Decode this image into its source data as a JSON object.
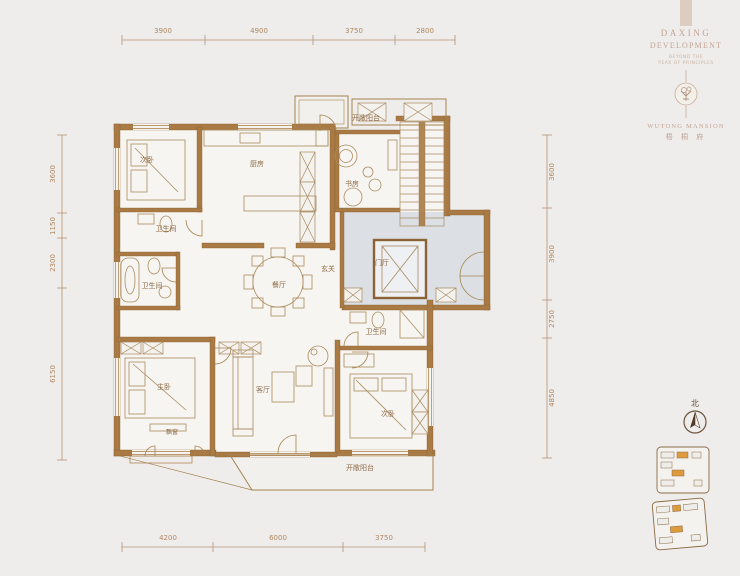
{
  "branding": {
    "developer_line1": "DAXING",
    "developer_line2": "DEVELOPMENT",
    "tagline_line1": "BEYOND THE",
    "tagline_line2": "PEAK OF PRINCIPLES",
    "project_name_en": "WUTONG MANSION",
    "project_name_cn": "梧 桐 府"
  },
  "compass": {
    "north_label": "北"
  },
  "floor_plan": {
    "rooms": [
      {
        "id": "bedroom2",
        "label": "次卧"
      },
      {
        "id": "kitchen",
        "label": "厨房"
      },
      {
        "id": "study",
        "label": "书房"
      },
      {
        "id": "bath-top",
        "label": "卫生间"
      },
      {
        "id": "bath-left",
        "label": "卫生间"
      },
      {
        "id": "dining",
        "label": "餐厅"
      },
      {
        "id": "hallway",
        "label": "玄关"
      },
      {
        "id": "foyer",
        "label": "门厅"
      },
      {
        "id": "balcony-top",
        "label": "开敞阳台"
      },
      {
        "id": "bath-bottom",
        "label": "卫生间"
      },
      {
        "id": "master-bedroom",
        "label": "主卧"
      },
      {
        "id": "living",
        "label": "客厅"
      },
      {
        "id": "bedroom3",
        "label": "次卧"
      },
      {
        "id": "bay-window",
        "label": "飘窗"
      },
      {
        "id": "balcony-bottom",
        "label": "开敞阳台"
      }
    ],
    "dimensions": {
      "top": [
        "3900",
        "4900",
        "3750",
        "2800"
      ],
      "bottom": [
        "4200",
        "6000",
        "3750"
      ],
      "left": [
        "3600",
        "1150",
        "2300",
        "6150"
      ],
      "right": [
        "3600",
        "3900",
        "2750",
        "4850"
      ]
    }
  },
  "colors": {
    "background": "#efedeb",
    "wall": "#a97a43",
    "line": "#a8895f",
    "room_text": "#8d6b46",
    "dimension_text": "#b08760",
    "core_shade": "#dce0e4",
    "brand_text": "#c3a392",
    "site_key_highlight": "#de9b3c"
  }
}
